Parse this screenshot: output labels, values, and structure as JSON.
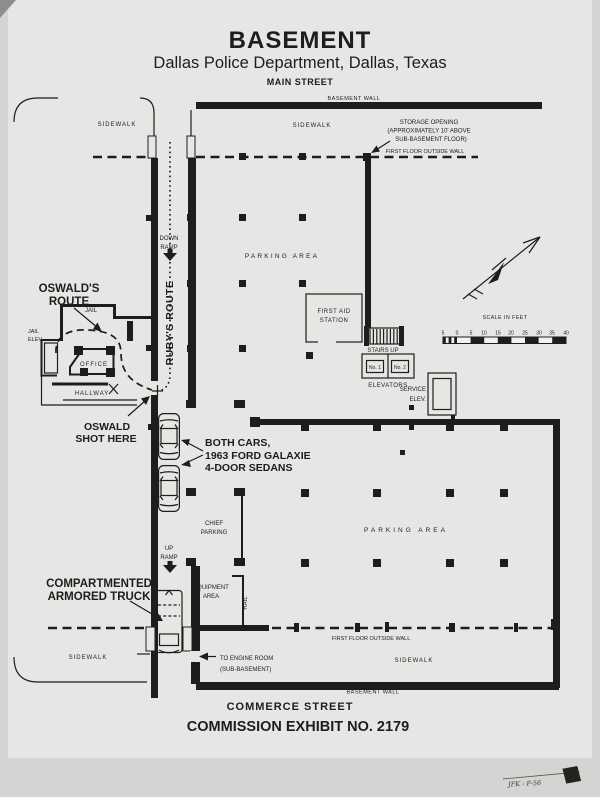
{
  "title": {
    "main": "BASEMENT",
    "subtitle": "Dallas Police Department, Dallas, Texas"
  },
  "streets": {
    "top": "MAIN STREET",
    "bottom": "COMMERCE STREET"
  },
  "exhibit": {
    "caption": "COMMISSION EXHIBIT NO. 2179"
  },
  "photo": {
    "annotation": "JFK - F-56"
  },
  "plan": {
    "basement_wall_top": "BASEMENT WALL",
    "basement_wall_bottom": "BASEMENT WALL",
    "first_floor_wall_top": "FIRST FLOOR OUTSIDE WALL",
    "first_floor_wall_bottom": "FIRST FLOOR OUTSIDE WALL",
    "sidewalk_nw": "SIDEWALK",
    "sidewalk_ne": "SIDEWALK",
    "sidewalk_sw": "SIDEWALK",
    "sidewalk_se": "SIDEWALK",
    "storage_opening": {
      "line1": "STORAGE OPENING",
      "line2": "(APPROXIMATELY 10' ABOVE",
      "line3": "SUB-BASEMENT FLOOR)"
    },
    "parking_area_upper": "PARKING AREA",
    "parking_area_lower": "PARKING AREA",
    "first_aid": {
      "line1": "FIRST AID",
      "line2": "STATION"
    },
    "stairs_up": "STAIRS UP",
    "elevators": "ELEVATORS",
    "elevator_no1": "No. 1",
    "elevator_no2": "No. 2",
    "service_elev": {
      "line1": "SERVICE",
      "line2": "ELEV."
    },
    "down_ramp": {
      "line1": "DOWN",
      "line2": "RAMP"
    },
    "up_ramp": {
      "line1": "UP",
      "line2": "RAMP"
    },
    "rubys_route": "RUBY'S ROUTE",
    "oswalds_route": {
      "line1": "OSWALD'S",
      "line2": "ROUTE"
    },
    "jail": "JAIL",
    "jail_elev": {
      "line1": "JAIL",
      "line2": "ELEV."
    },
    "office": "OFFICE",
    "hallway": "HALLWAY",
    "oswald_shot": {
      "line1": "OSWALD",
      "line2": "SHOT HERE"
    },
    "both_cars": {
      "line1": "BOTH CARS,",
      "line2": "1963 FORD GALAXIE",
      "line3": "4-DOOR SEDANS"
    },
    "chief_parking": {
      "line1": "CHIEF",
      "line2": "PARKING"
    },
    "armored_truck": {
      "line1": "COMPARTMENTED",
      "line2": "ARMORED TRUCK"
    },
    "equipment_area": {
      "line1": "EQUIPMENT",
      "line2": "AREA"
    },
    "rail": "RAIL",
    "engine_room": {
      "line1": "TO ENGINE ROOM",
      "line2": "(SUB-BASEMENT)"
    }
  },
  "scale": {
    "title": "SCALE IN FEET",
    "ticks": [
      "5",
      "0",
      "5",
      "10",
      "15",
      "20",
      "25",
      "30",
      "35",
      "40"
    ]
  },
  "colors": {
    "ink": "#1d1d1b",
    "paper": "#e6e6e4",
    "photo_bg": "#d4d4d2"
  }
}
